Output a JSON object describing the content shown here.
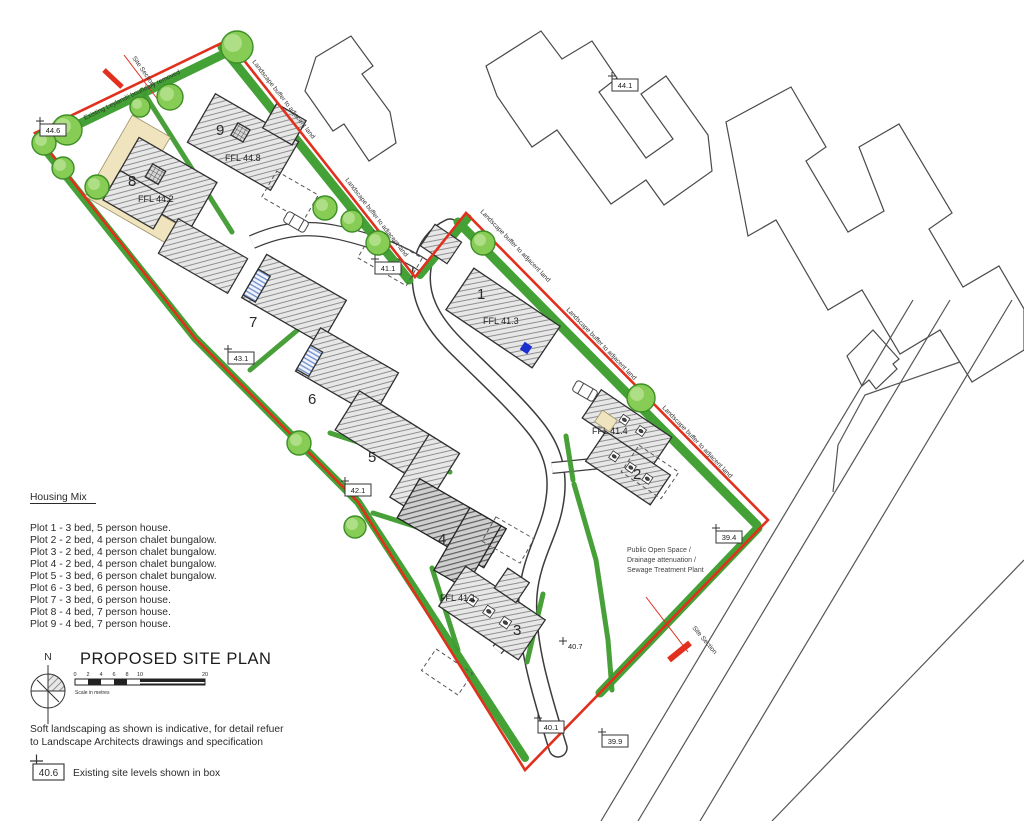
{
  "drawing": {
    "title": "PROPOSED SITE PLAN",
    "north_label": "N",
    "scale_ticks": [
      "0",
      "2",
      "4",
      "6",
      "8",
      "10",
      "20"
    ],
    "scale_caption": "Scale in metres"
  },
  "housing_mix": {
    "heading": "Housing Mix",
    "items": [
      "Plot 1 - 3 bed, 5 person house.",
      "Plot 2 - 2 bed, 4 person chalet bungalow.",
      "Plot 3 - 2 bed, 4 person chalet bungalow.",
      "Plot 4 - 2 bed, 4 person chalet bungalow.",
      "Plot 5 - 3 bed, 6 person chalet bungalow.",
      "Plot 6 - 3 bed, 6 person house.",
      "Plot 7 - 3 bed, 6 person house.",
      "Plot 8 - 4 bed, 7 person house.",
      "Plot 9 - 4 bed, 7 person house."
    ]
  },
  "notes": {
    "landscaping_line1": "Soft landscaping as shown is indicative, for detail refuer",
    "landscaping_line2": "to Landscape Architects drawings and specification",
    "level_box_example": "40.6",
    "level_caption": "Existing site levels shown in box"
  },
  "annotations": {
    "existing_boundary": "Existing Leylandii boundary removed",
    "buffer_label": "Landscape buffer to adjacent land",
    "site_section": "Site Section",
    "pos_line1": "Public Open Space /",
    "pos_line2": "Drainage attenuation /",
    "pos_line3": "Sewage Treatment Plant"
  },
  "plots": {
    "p1": {
      "number": "1",
      "ffl": "FFL 41.3"
    },
    "p2": {
      "number": "2",
      "ffl": "FFL 41.4"
    },
    "p3": {
      "number": "3",
      "ffl": "FFL 41.1"
    },
    "p4": {
      "number": "4"
    },
    "p5": {
      "number": "5"
    },
    "p6": {
      "number": "6"
    },
    "p7": {
      "number": "7"
    },
    "p8": {
      "number": "8",
      "ffl": "FFL 44.2"
    },
    "p9": {
      "number": "9",
      "ffl": "FFL 44.8"
    }
  },
  "levels": [
    {
      "v": "44.6"
    },
    {
      "v": "44.1"
    },
    {
      "v": "43.1"
    },
    {
      "v": "42.1"
    },
    {
      "v": "41.1"
    },
    {
      "v": "39.4"
    },
    {
      "v": "40.1"
    },
    {
      "v": "39.9"
    }
  ],
  "unboxed_level": "40.7",
  "colors": {
    "boundary_red": "#e1301d",
    "buffer_green": "#43a135",
    "tree_green": "#86cc55",
    "beige": "#efe4bd",
    "marker_blue": "#1b2fd0"
  }
}
